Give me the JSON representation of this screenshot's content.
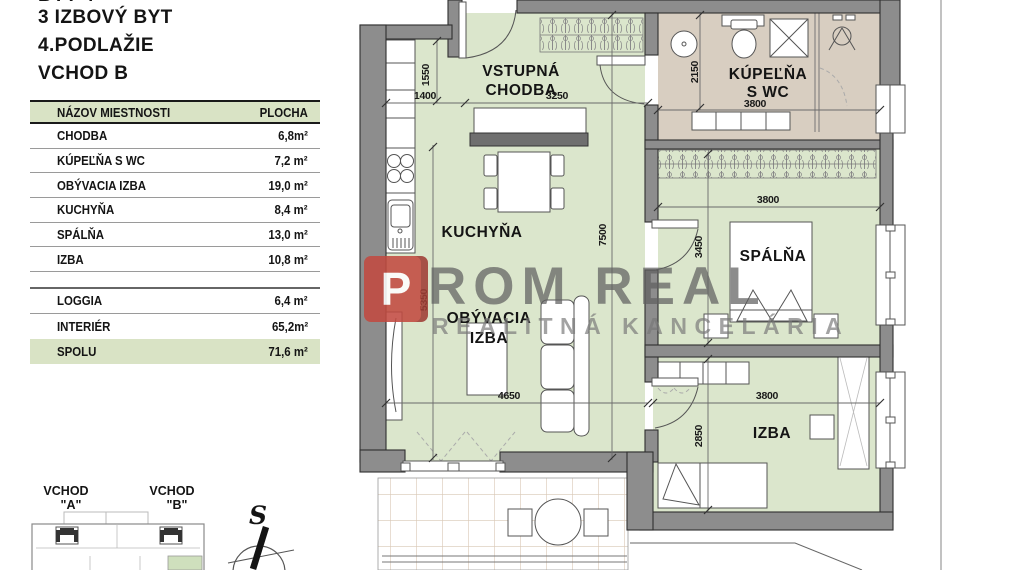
{
  "colors": {
    "plan_green": "#dbe6cc",
    "bath_beige": "#d8cec1",
    "wall_gray": "#8d8d8d",
    "table_green": "#d9e3c5",
    "unit_green": "#cfe0bd",
    "logo_red": "#c24b41",
    "logo_gray": "#808080"
  },
  "header": {
    "partial_line": "BYT 4",
    "title": "3 IZBOVÝ BYT",
    "floor": "4.PODLAŽIE",
    "entrance": "VCHOD B"
  },
  "table": {
    "col_name": "NÁZOV MIESTNOSTI",
    "col_area": "PLOCHA",
    "rows": [
      {
        "name": "CHODBA",
        "area": "6,8m²"
      },
      {
        "name": "KÚPEĽŇA S WC",
        "area": "7,2 m²"
      },
      {
        "name": "OBÝVACIA IZBA",
        "area": "19,0 m²"
      },
      {
        "name": "KUCHYŇA",
        "area": "8,4 m²"
      },
      {
        "name": "SPÁLŇA",
        "area": "13,0 m²"
      },
      {
        "name": "IZBA",
        "area": "10,8 m²"
      }
    ],
    "extra_rows": [
      {
        "name": "LOGGIA",
        "area": "6,4 m²"
      },
      {
        "name": "INTERIÉR",
        "area": "65,2m²"
      }
    ],
    "total": {
      "name": "SPOLU",
      "area": "71,6 m²"
    }
  },
  "plan": {
    "rooms": {
      "hall": {
        "line1": "VSTUPNÁ",
        "line2": "CHODBA"
      },
      "bathroom": {
        "line1": "KÚPEĽŇA",
        "line2": "S WC"
      },
      "kitchen": {
        "label": "KUCHYŇA"
      },
      "bedroom": {
        "label": "SPÁLŇA"
      },
      "living": {
        "line1": "OBÝVACIA",
        "line2": "IZBA"
      },
      "room": {
        "label": "IZBA"
      }
    },
    "dims": {
      "hall_w1": "1400",
      "hall_h": "1550",
      "hall_w2": "3250",
      "bath_h": "2150",
      "bath_w": "3800",
      "plan_h": "7500",
      "living_h": "5350",
      "bedroom_h": "3450",
      "bedroom_w": "3800",
      "living_w": "4650",
      "room_h": "2850",
      "room_w": "3800"
    }
  },
  "logo": {
    "mark": "P",
    "name": "ROM REAL",
    "tagline": "REALITNÁ KANCELÁRIA"
  },
  "site": {
    "entrance_a": "VCHOD",
    "entrance_a_mark": "\"A\"",
    "entrance_b": "VCHOD",
    "entrance_b_mark": "\"B\"",
    "compass": "S"
  }
}
